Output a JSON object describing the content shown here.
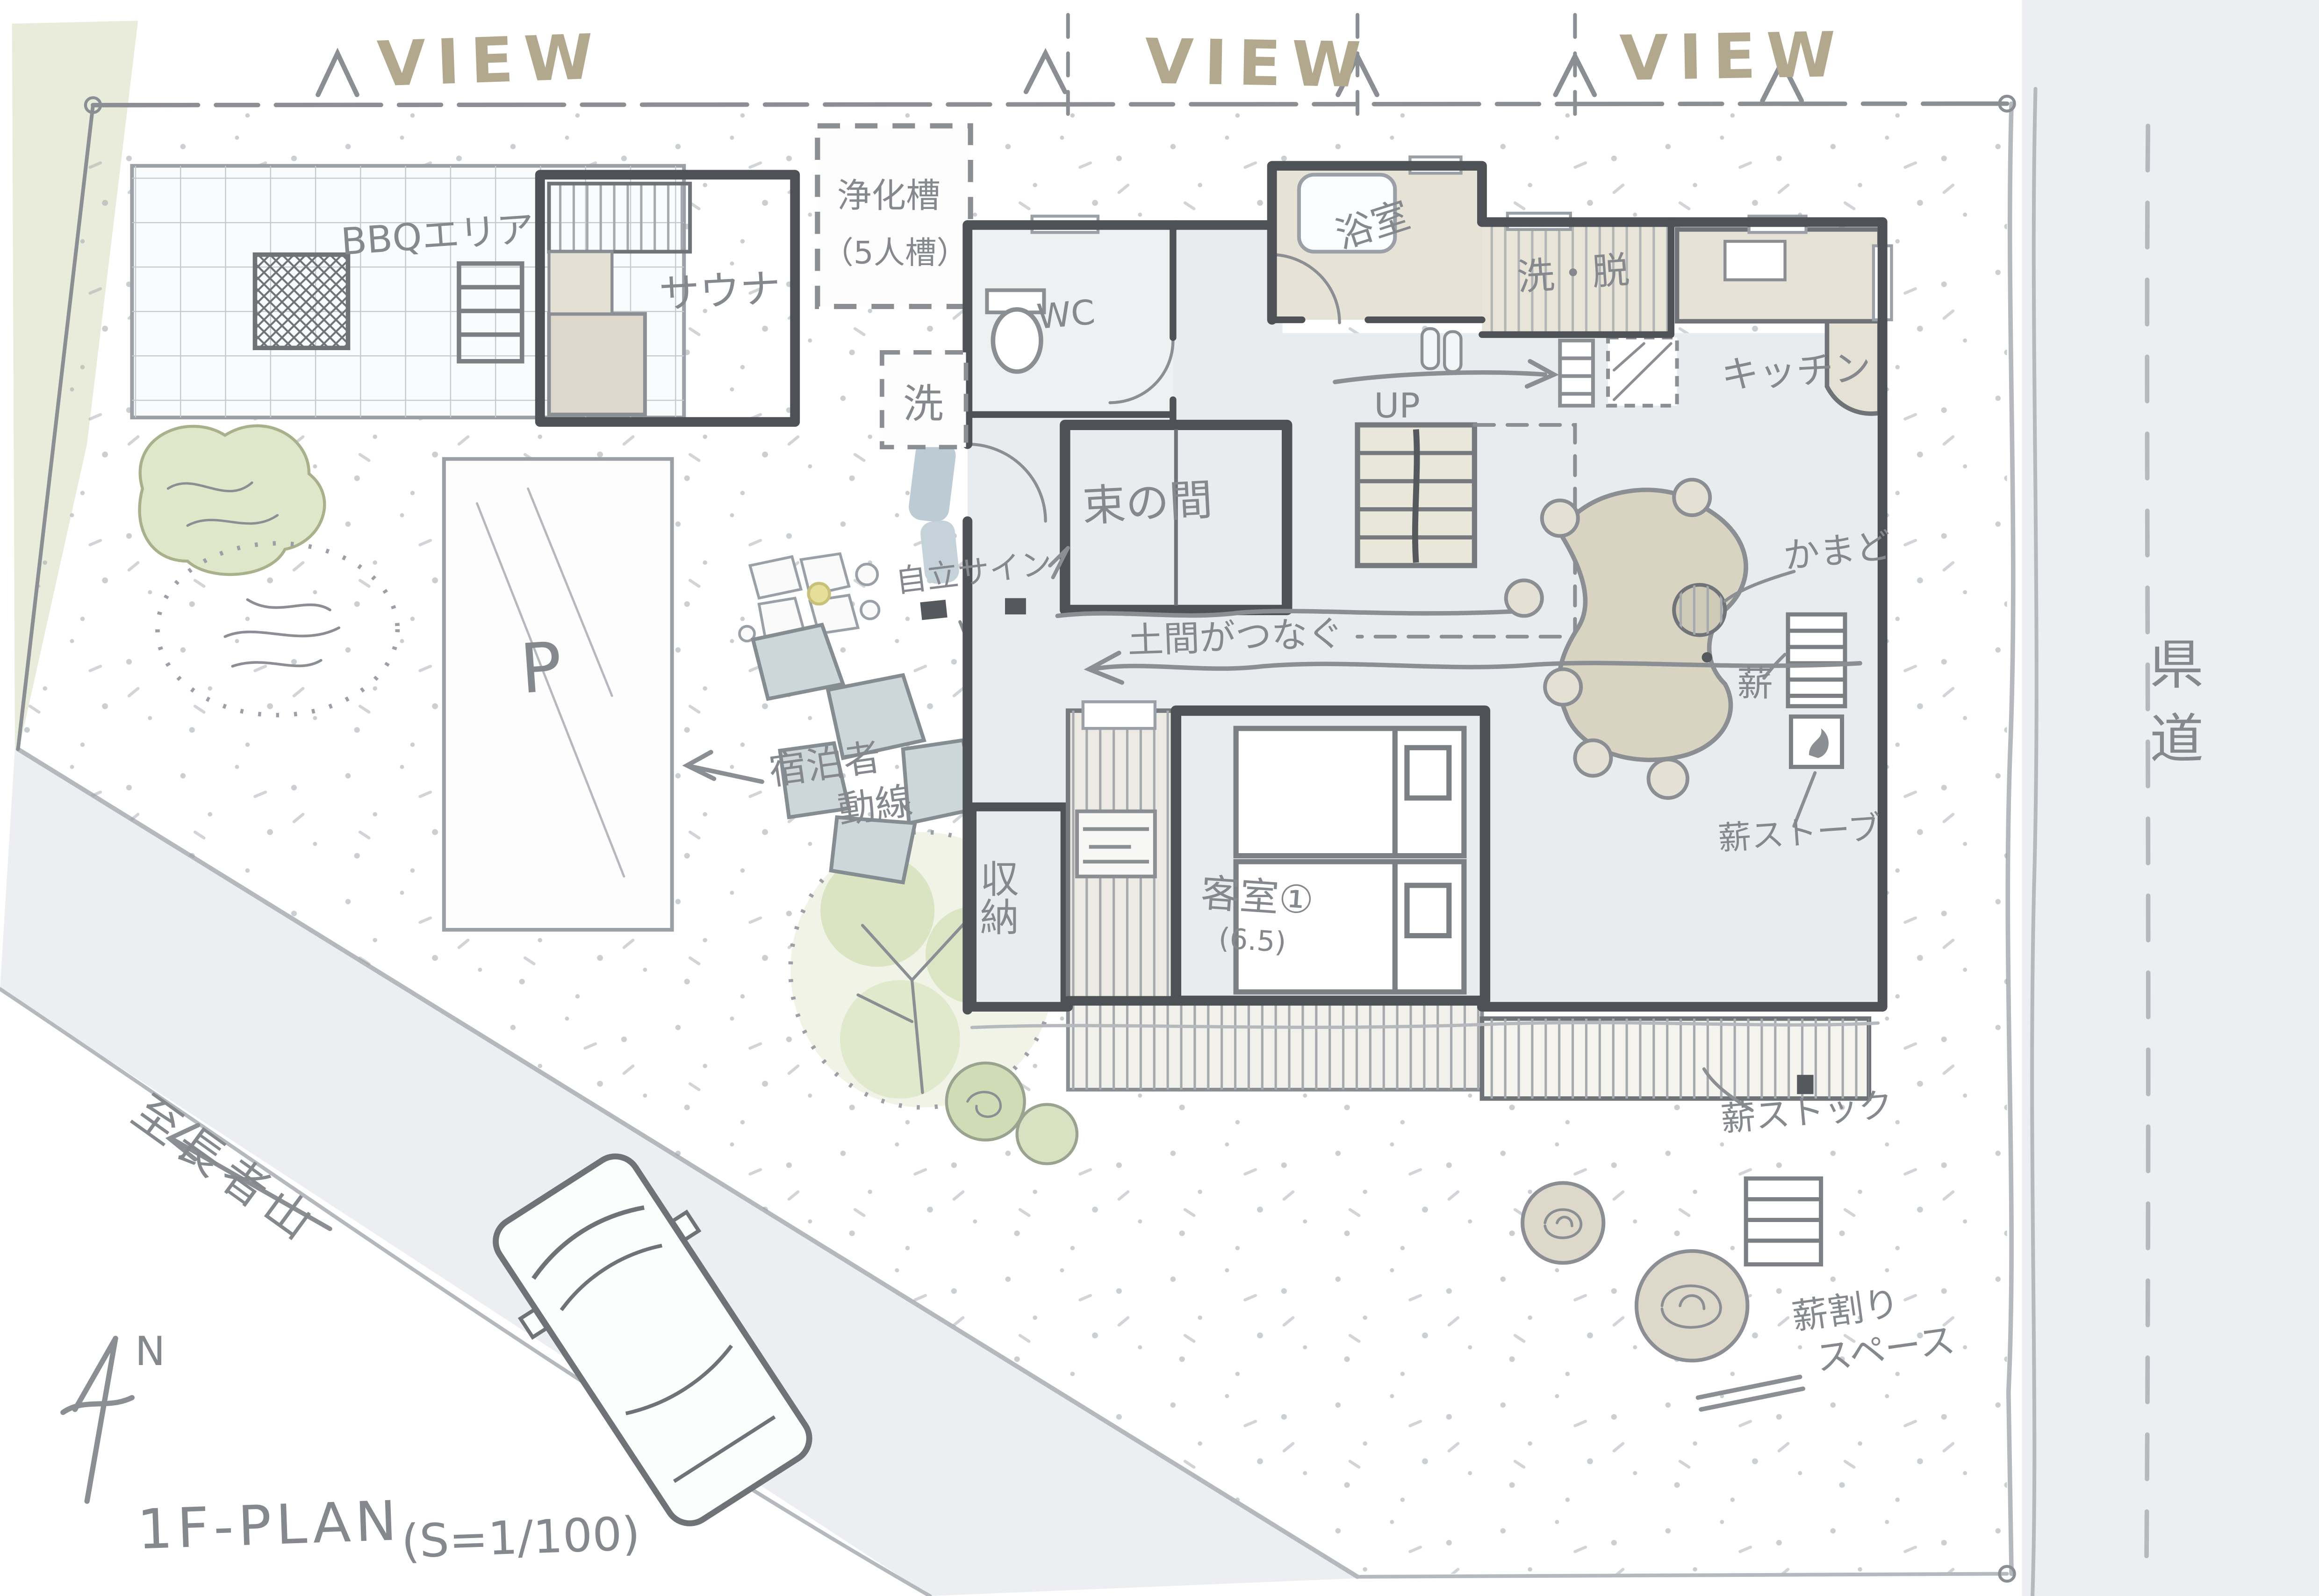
{
  "header": {
    "view_label_1": "VIEW",
    "view_label_2": "VIEW",
    "view_label_3": "VIEW"
  },
  "site": {
    "prefectural_road": "県道",
    "to_mountain": "至長者山",
    "parking": "P",
    "septic_line1": "浄化槽",
    "septic_line2": "（5人槽）",
    "bbq_area": "BBQエリア",
    "sauna": "サウナ"
  },
  "rooms": {
    "wc": "WC",
    "laundry": "洗",
    "bath": "浴室",
    "wash_dress": "洗・脱",
    "kitchen": "キッチン",
    "stairs_up": "UP",
    "tsukanoma": "束の間",
    "storage": "収納",
    "guest_room": "客室①",
    "guest_room_size": "(6.5)"
  },
  "annotations": {
    "doma_connect": "土間がつなぐ",
    "kamado": "かまど",
    "firewood": "薪",
    "wood_stove": "薪ストーブ",
    "firewood_stock": "薪ストック",
    "wood_split_line1": "薪割り",
    "wood_split_line2": "スペース",
    "guest_flow_line1": "宿泊者",
    "guest_flow_line2": "動線",
    "free_sign": "自立サイン"
  },
  "footer": {
    "north": "N",
    "plan_title": "1F-PLAN",
    "plan_scale": "(S=1/100)"
  },
  "colors": {
    "view_tan": "#b2a88e",
    "ink_gray": "#85888c",
    "wall_gray": "#4e5155",
    "hall_floor": "#e9ecef",
    "tatami_tan": "#d7d2c3",
    "bath_tan": "#e6e2d6",
    "table_tan": "#d9d3c2",
    "road_gray": "#eceef1",
    "tree_green": "#dfe6ca",
    "stone_blue": "#ccd6db"
  }
}
